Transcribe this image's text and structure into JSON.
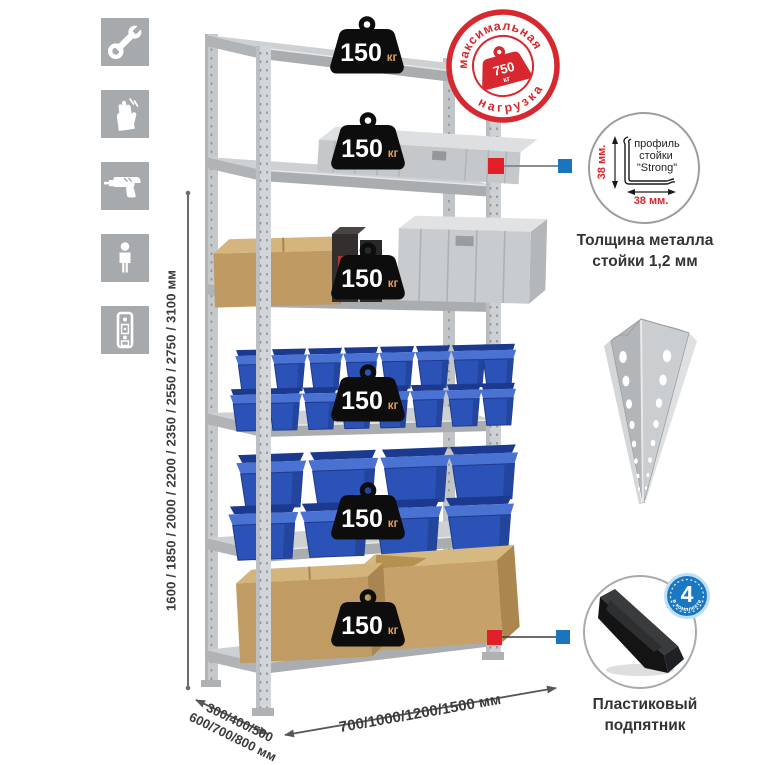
{
  "left_icons": [
    "wrench",
    "gloves",
    "drill",
    "person",
    "rack-upright"
  ],
  "dimensions": {
    "height": "1600 / 1850 / 2000 / 2200 / 2350 / 2550 / 2750 / 3100 мм",
    "depth_line1": "300/400/500",
    "depth_line2": "600/700/800 мм",
    "width": "700/1000/1200/1500 мм"
  },
  "rack": {
    "load_badges": [
      {
        "value": "150",
        "unit": "кг"
      },
      {
        "value": "150",
        "unit": "кг"
      },
      {
        "value": "150",
        "unit": "кг"
      },
      {
        "value": "150",
        "unit": "кг"
      },
      {
        "value": "150",
        "unit": "кг"
      },
      {
        "value": "150",
        "unit": "кг"
      }
    ]
  },
  "stamp": {
    "arc_top": "максимальная",
    "arc_bottom": "нагрузка",
    "value": "750",
    "unit": "кг"
  },
  "profile_detail": {
    "label_line1": "профиль",
    "label_line2": "стойки",
    "label_line3": "\"Strong\"",
    "dim_left": "38 мм.",
    "dim_bottom": "38 мм.",
    "caption_line1": "Толщина металла",
    "caption_line2": "стойки 1,2 мм"
  },
  "foot": {
    "badge_value": "4",
    "badge_arc": "в комплекте",
    "caption_line1": "Пластиковый",
    "caption_line2": "подпятник"
  },
  "colors": {
    "accent_red": "#d7282f",
    "square_red": "#e01f26",
    "square_blue": "#1b75bc",
    "metal": "#ced1d3",
    "bin_blue": "#2b52b6",
    "cardboard": "#c09a63",
    "icon_bg": "#a6aaad",
    "badge_black": "#0d0d0d"
  }
}
